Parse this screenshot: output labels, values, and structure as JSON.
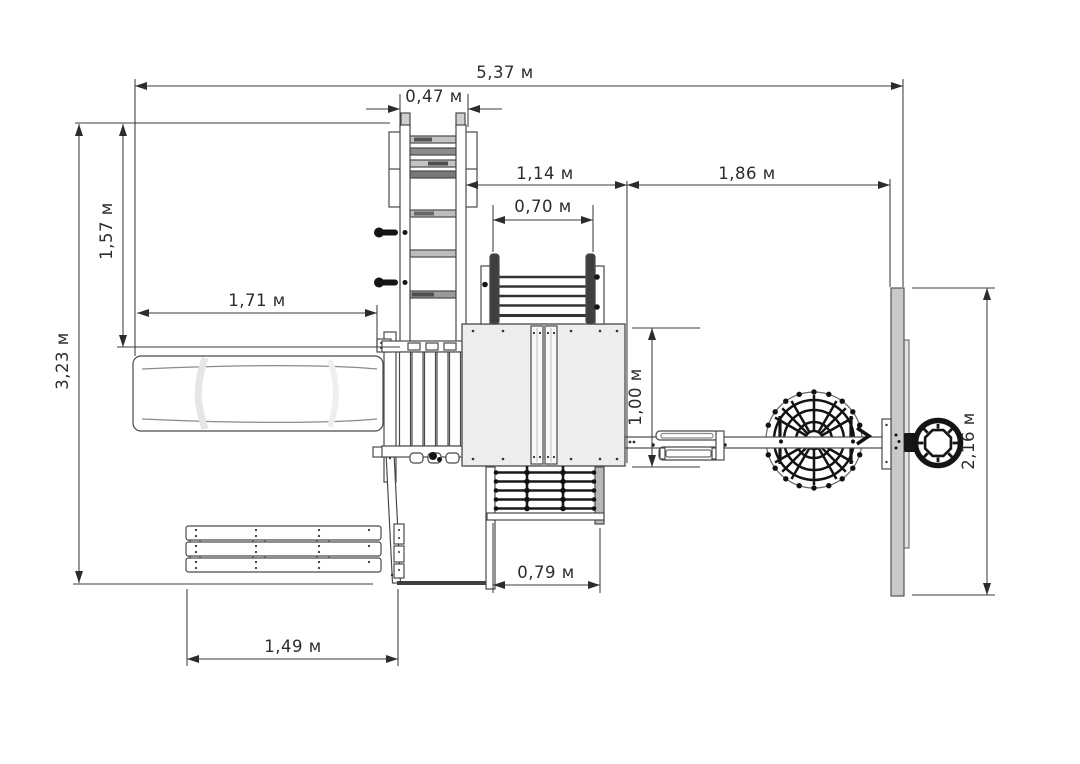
{
  "drawing": {
    "title": "Playground set — top view plan",
    "unit": "м",
    "labels": {
      "total_width": "5,37 м",
      "ladder_width": "0,47 м",
      "ladder_to_platform_gap": "1,14 м",
      "platform_to_climbwall_gap": "1,86 м",
      "handrail_width": "0,70 м",
      "upper_depth": "1,57 м",
      "slide_length": "1,71 м",
      "total_depth": "3,23 м",
      "platform_depth": "1,00 м",
      "climbwall_length": "2,16 м",
      "net_width": "0,79 м",
      "bench_length": "1,49 м"
    },
    "colors": {
      "background": "#ffffff",
      "line": "#4a4a4a",
      "dimension_line": "#3c3c3c",
      "platform_fill": "#ededed",
      "climbwall_fill": "#c9c9c9",
      "dark_detail": "#141414"
    }
  }
}
